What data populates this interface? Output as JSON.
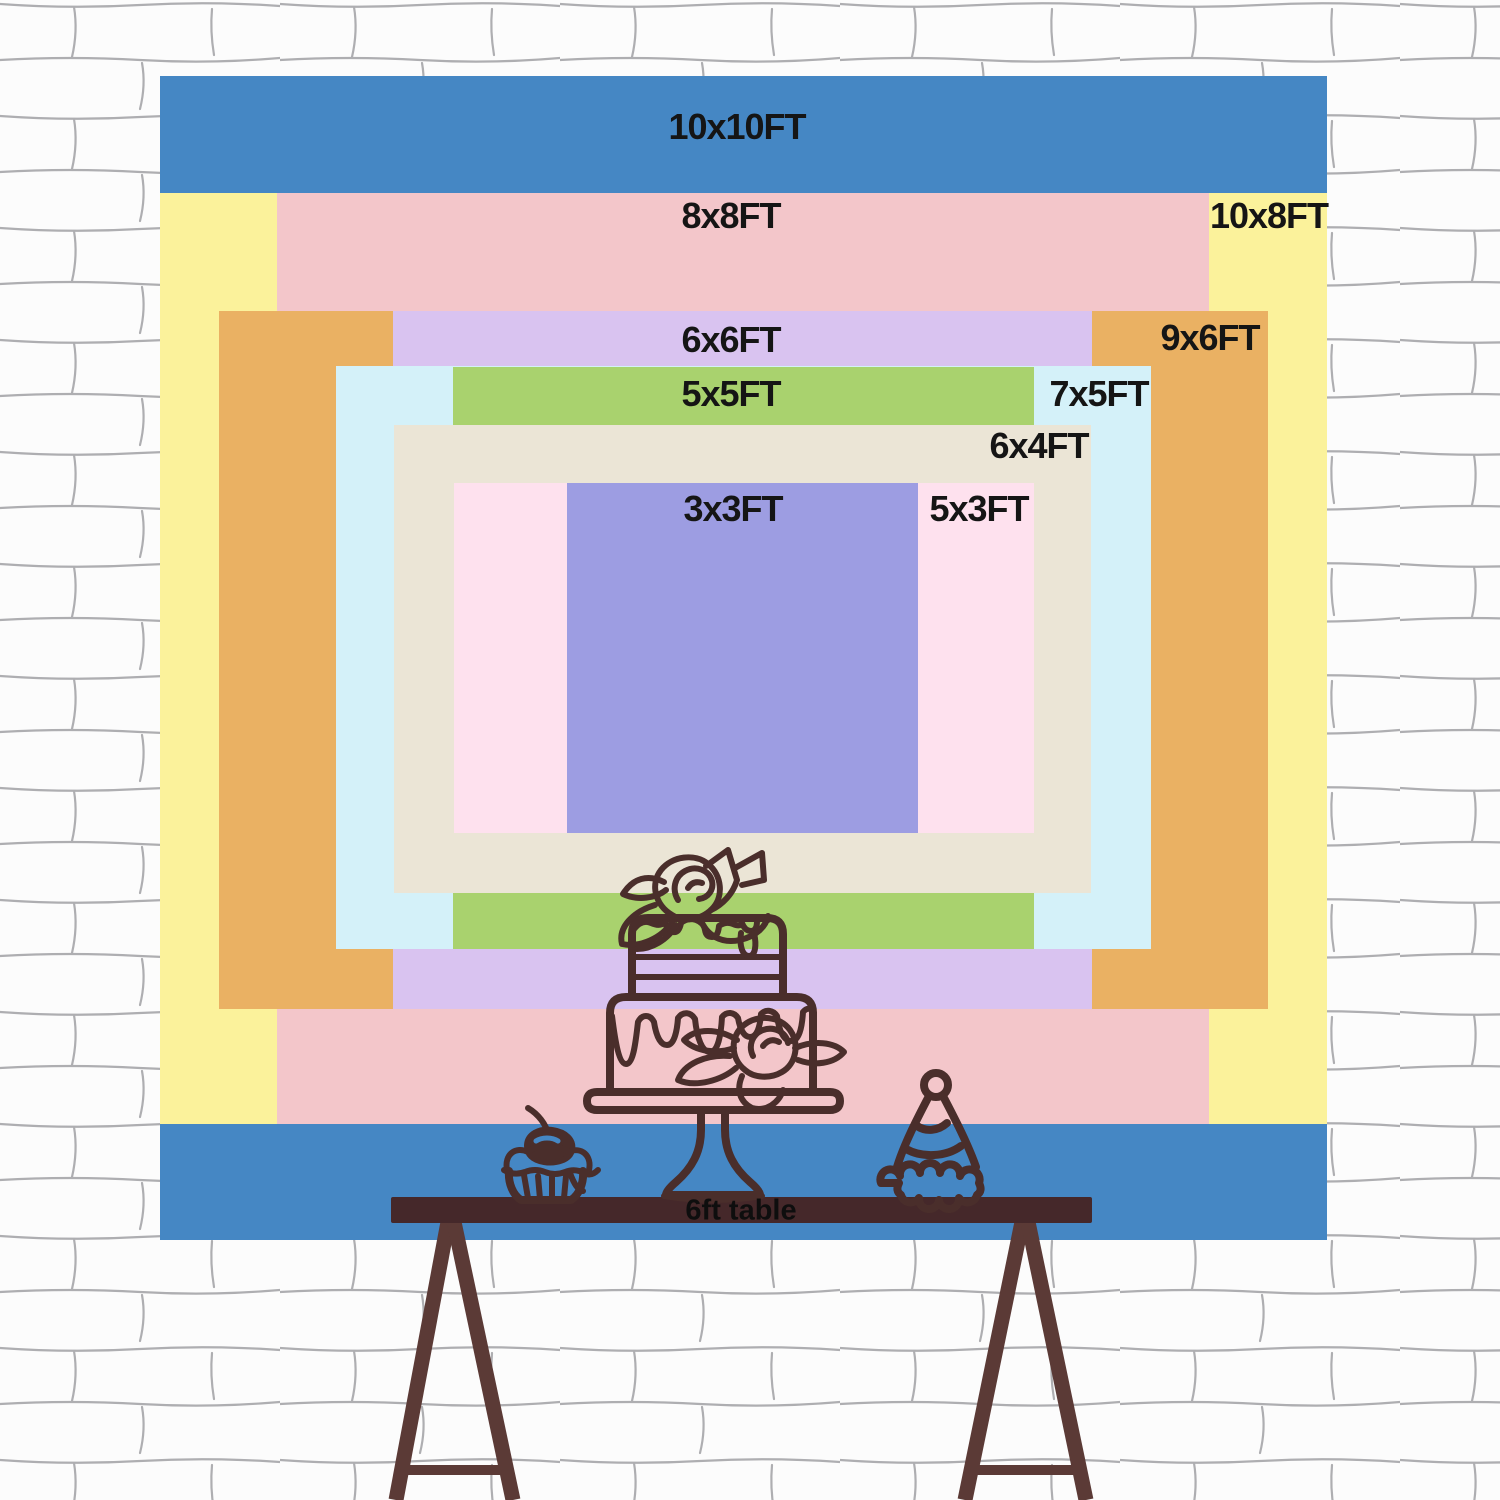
{
  "poster": {
    "title": "Backdrop size comparison chart",
    "unit": "FT"
  },
  "backdrop": {
    "label_color": "#151515",
    "sizes": [
      {
        "id": "10x10ft",
        "label": "10x10FT",
        "w_ft": 10,
        "h_ft": 10,
        "color": "#4587c4",
        "x": 160,
        "y": 76,
        "w": 1167,
        "h": 1164,
        "label_x": 737,
        "label_y": 127
      },
      {
        "id": "10x8ft",
        "label": "10x8FT",
        "w_ft": 10,
        "h_ft": 8,
        "color": "#fbf29b",
        "x": 160,
        "y": 193,
        "w": 1167,
        "h": 931,
        "label_x": 1269,
        "label_y": 216
      },
      {
        "id": "8x8ft",
        "label": "8x8FT",
        "w_ft": 8,
        "h_ft": 8,
        "color": "#f3c6ca",
        "x": 277,
        "y": 193,
        "w": 932,
        "h": 931,
        "label_x": 731,
        "label_y": 216
      },
      {
        "id": "9x6ft",
        "label": "9x6FT",
        "w_ft": 9,
        "h_ft": 6,
        "color": "#eab163",
        "x": 219,
        "y": 311,
        "w": 1049,
        "h": 698,
        "label_x": 1210,
        "label_y": 338
      },
      {
        "id": "6x6ft",
        "label": "6x6FT",
        "w_ft": 6,
        "h_ft": 6,
        "color": "#d9c3f0",
        "x": 393,
        "y": 311,
        "w": 699,
        "h": 698,
        "label_x": 731,
        "label_y": 340
      },
      {
        "id": "7x5ft",
        "label": "7x5FT",
        "w_ft": 7,
        "h_ft": 5,
        "color": "#d4f1f9",
        "x": 336,
        "y": 366,
        "w": 815,
        "h": 583,
        "label_x": 1099,
        "label_y": 394
      },
      {
        "id": "5x5ft",
        "label": "5x5FT",
        "w_ft": 5,
        "h_ft": 5,
        "color": "#a9d26e",
        "x": 453,
        "y": 367,
        "w": 581,
        "h": 582,
        "label_x": 731,
        "label_y": 394
      },
      {
        "id": "6x4ft",
        "label": "6x4FT",
        "w_ft": 6,
        "h_ft": 4,
        "color": "#ebe5d6",
        "x": 394,
        "y": 425,
        "w": 697,
        "h": 468,
        "label_x": 1039,
        "label_y": 446
      },
      {
        "id": "5x3ft",
        "label": "5x3FT",
        "w_ft": 5,
        "h_ft": 3,
        "color": "#fee1ee",
        "x": 454,
        "y": 483,
        "w": 580,
        "h": 350,
        "label_x": 979,
        "label_y": 509
      },
      {
        "id": "3x3ft",
        "label": "3x3FT",
        "w_ft": 3,
        "h_ft": 3,
        "color": "#9d9de2",
        "x": 567,
        "y": 483,
        "w": 351,
        "h": 350,
        "label_x": 733,
        "label_y": 509
      }
    ]
  },
  "table": {
    "label": "6ft table",
    "label_x": 741,
    "label_y": 1211,
    "bar_color": "#45282a",
    "leg_color": "#5b3a36"
  },
  "artwork": {
    "line_color": "#4a2e2b",
    "items": [
      "tiered-cake",
      "cupcake",
      "party-hat",
      "trestle-table"
    ]
  },
  "wall": {
    "base_color": "#fcfcfc",
    "mortar_color": "#5f5f66"
  }
}
